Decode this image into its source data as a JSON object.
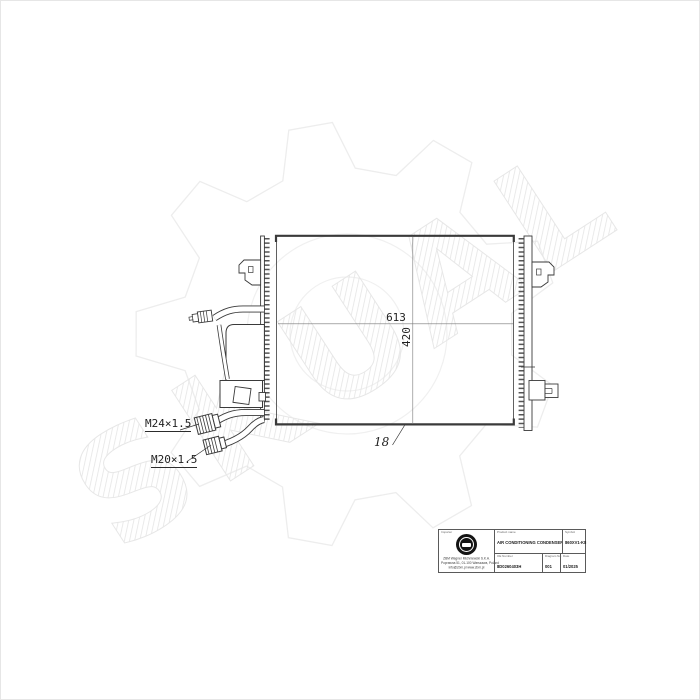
{
  "watermark": {
    "text": "SKUAL"
  },
  "drawing": {
    "width_dim": "613",
    "height_dim": "420",
    "core_thickness_dim": "18",
    "fitting_top_label": "M24×1.5",
    "fitting_bottom_label": "M20×1.5"
  },
  "title_block": {
    "importer_label": "Importer",
    "company_line1": "ZBM Wagner Michniewski S.K.A.",
    "company_line2": "Poprawna 51, 01-100 Warszawa, Poland",
    "company_line3": "info@zbm.pl  www.zbm.pl",
    "product_name_label": "Product name",
    "product_name": "AIR CONDITIONING CONDENSER",
    "symbol_label": "Symbol",
    "symbol": "860XV1-K8",
    "oe_number_label": "OE Number",
    "oe_number": "8D0260403H",
    "diagram_no_label": "Diagram No.",
    "diagram_no": "001",
    "date_label": "Date",
    "date": "01/2025"
  }
}
